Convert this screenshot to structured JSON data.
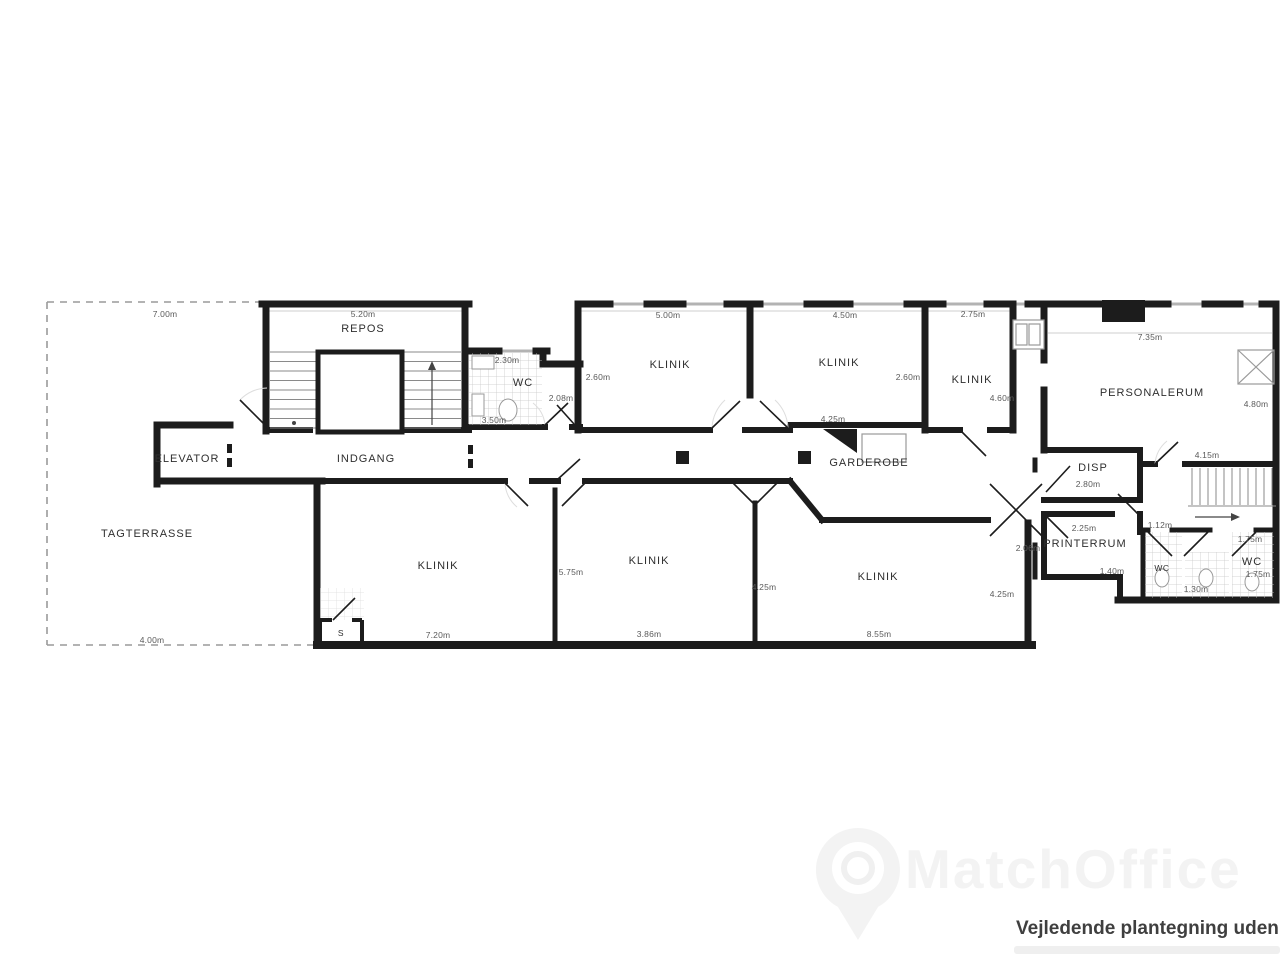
{
  "watermark": {
    "brand": "MatchOffice"
  },
  "footer": {
    "disclaimer": "Vejledende plantegning uden a"
  },
  "plan": {
    "rooms": {
      "tagterrasse": "TAGTERRASSE",
      "repos": "REPOS",
      "elevator": "ELEVATOR",
      "indgang": "INDGANG",
      "wc_top": "WC",
      "klinik_top_1": "KLINIK",
      "klinik_top_2": "KLINIK",
      "klinik_top_3": "KLINIK",
      "garderobe": "GARDEROBE",
      "personalerum": "PERSONALERUM",
      "disp": "DISP",
      "printerrum": "PRINTERRUM",
      "wc_right_1": "WC",
      "wc_right_2": "WC",
      "klinik_bottom_1": "KLINIK",
      "klinik_bottom_2": "KLINIK",
      "klinik_bottom_3": "KLINIK",
      "stair_s": "S"
    },
    "dimensions": {
      "terrace_width": "7.00m",
      "repos_width": "5.20m",
      "klinik1_width": "5.00m",
      "klinik2_width": "4.50m",
      "klinik3_width": "2.75m",
      "personalerum_width": "7.35m",
      "wc_width": "2.30m",
      "wc_bottom": "3.50m",
      "wc_niche": "2.08m",
      "klinik1_left": "2.60m",
      "klinik2_right": "2.60m",
      "klinik3_right": "4.60m",
      "garderobe_width": "4.25m",
      "personalerum_height": "4.80m",
      "personalerum_bottom": "4.15m",
      "disp_width": "2.80m",
      "printerrum_width": "2.25m",
      "printerrum_left": "2.06m",
      "printerrum_bottom": "1.40m",
      "wc_r1_width": "1.12m",
      "wc_r2_top": "1.75m",
      "wc_r2_right": "1.75m",
      "wc_lobby_width": "1.30m",
      "klinik_b1_width": "7.20m",
      "klinik_b2_left": "5.75m",
      "klinik_b2_width": "3.86m",
      "klinik_b3_left": "4.25m",
      "klinik_b3_width": "8.55m",
      "klinik_b3_right": "4.25m",
      "terrace_bottom": "4.00m"
    }
  }
}
